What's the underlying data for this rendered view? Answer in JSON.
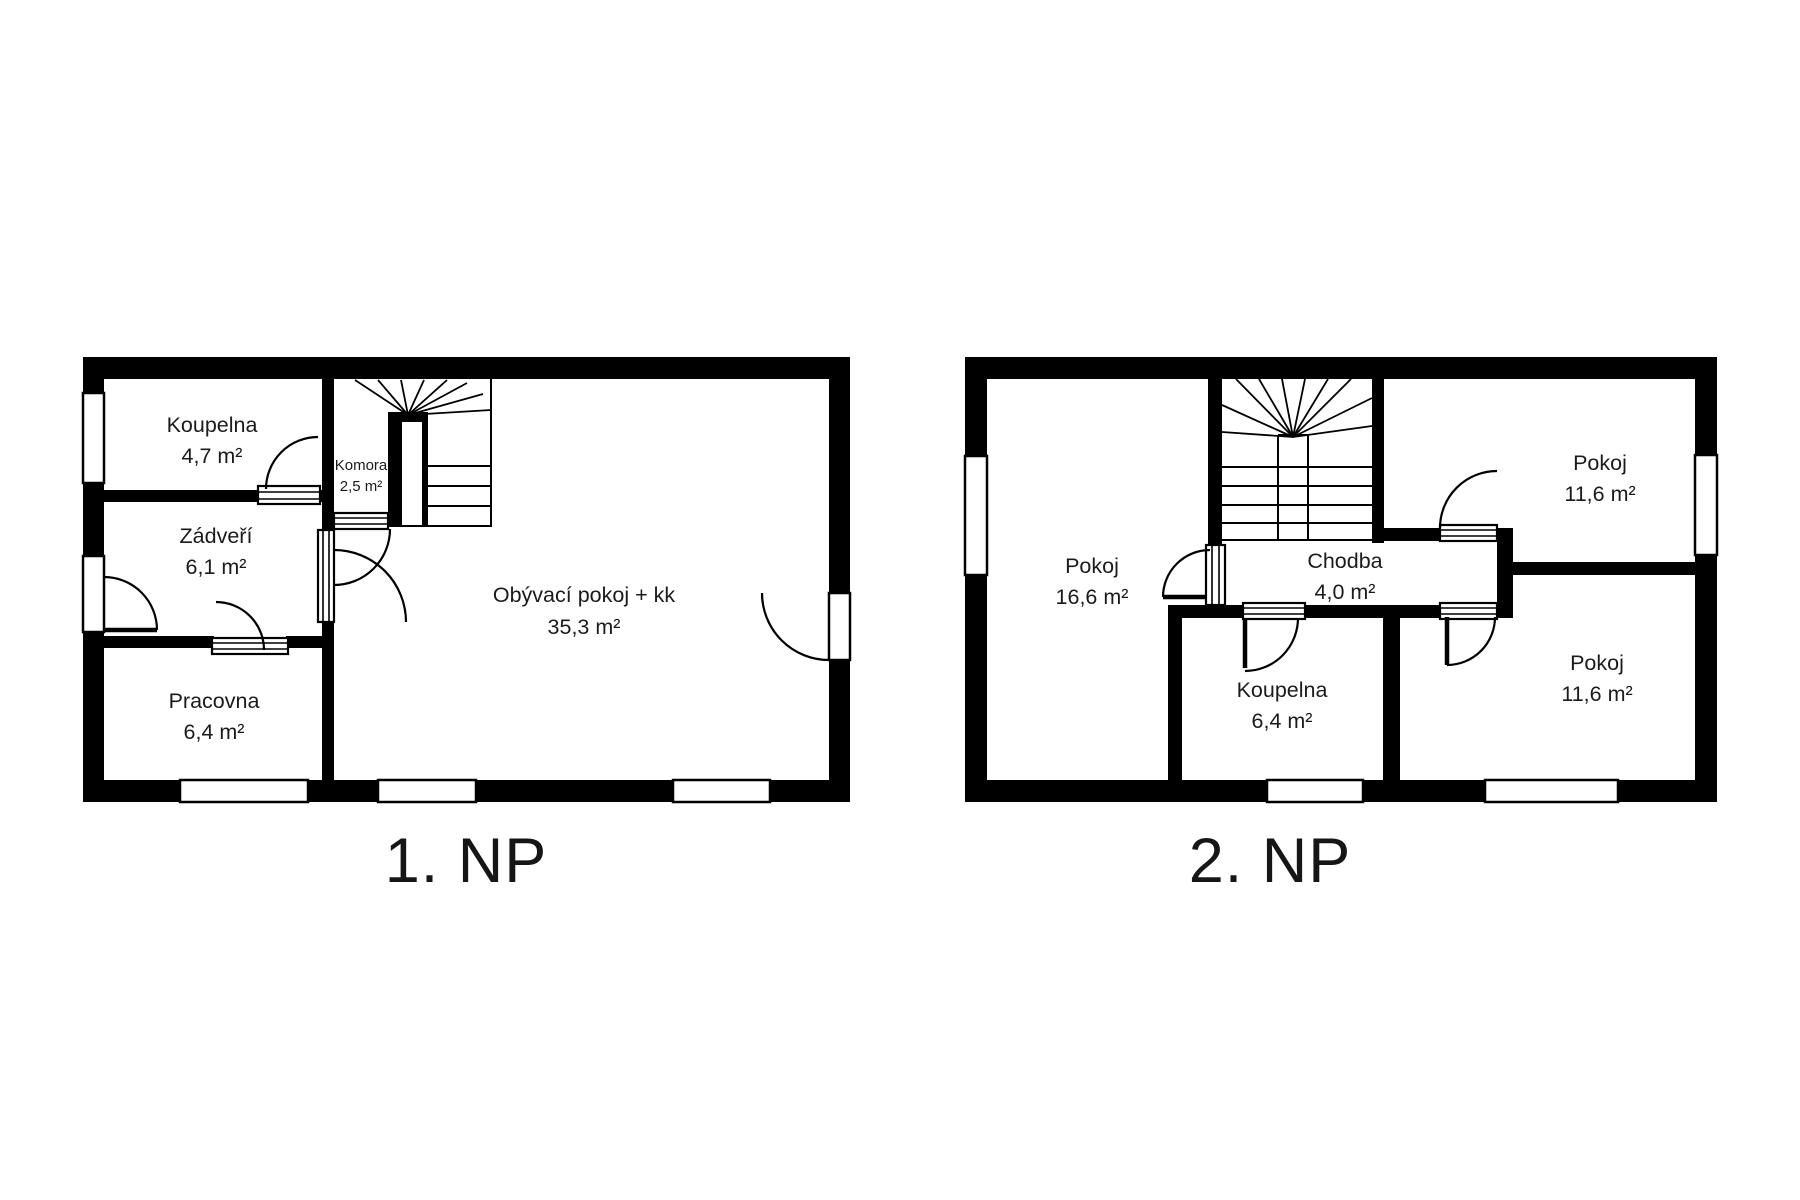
{
  "document": {
    "type": "floor-plan-drawing",
    "background_color": "#ffffff",
    "wall_color": "#000000",
    "text_color": "#1b1b1b"
  },
  "floors": [
    {
      "title": "1. NP",
      "rooms": [
        {
          "name": "Koupelna",
          "area": "4,7 m²"
        },
        {
          "name": "Zádveří",
          "area": "6,1 m²"
        },
        {
          "name": "Pracovna",
          "area": "6,4 m²"
        },
        {
          "name": "Komora",
          "area": "2,5 m²"
        },
        {
          "name": "Obývací pokoj + kk",
          "area": "35,3 m²"
        }
      ]
    },
    {
      "title": "2. NP",
      "rooms": [
        {
          "name": "Pokoj",
          "area": "16,6 m²"
        },
        {
          "name": "Chodba",
          "area": "4,0 m²"
        },
        {
          "name": "Koupelna",
          "area": "6,4 m²"
        },
        {
          "name": "Pokoj",
          "area": "11,6 m²"
        },
        {
          "name": "Pokoj",
          "area": "11,6 m²"
        }
      ]
    }
  ]
}
